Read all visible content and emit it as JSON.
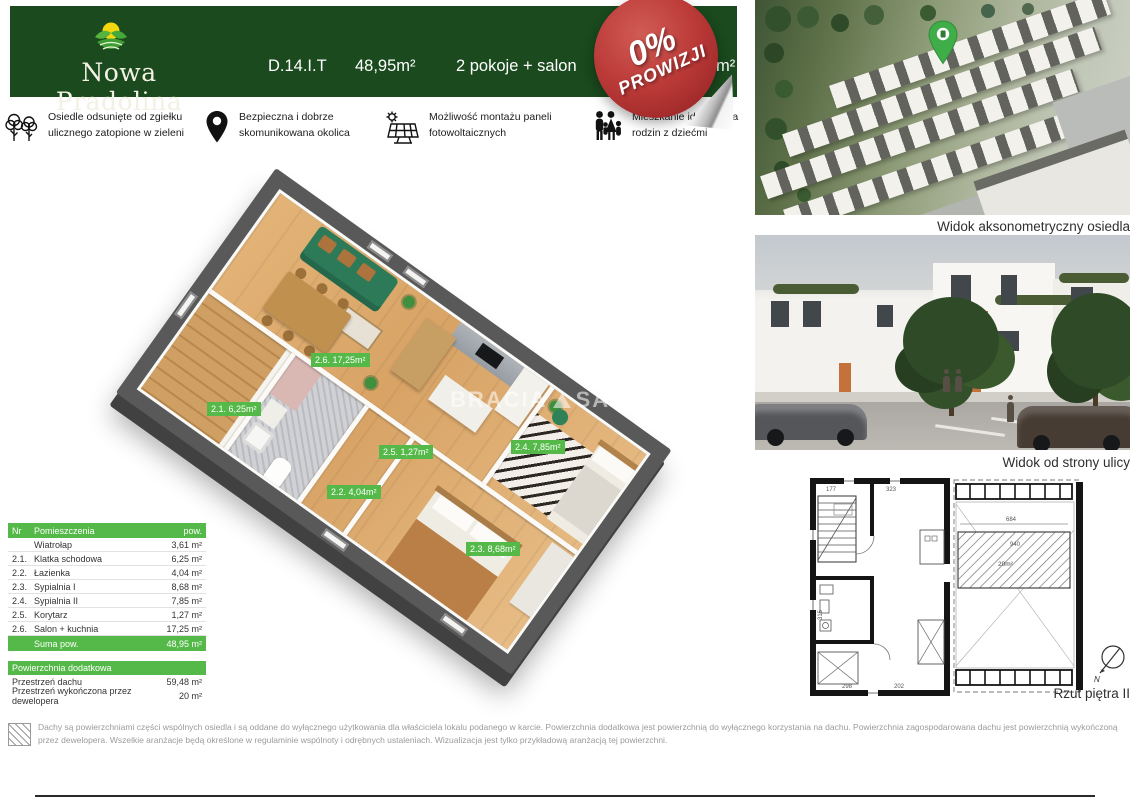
{
  "header": {
    "logo_text": "Nowa Pradolina",
    "unit_id": "D.14.I.T",
    "area": "48,95m²",
    "rooms": "2 pokoje + salon",
    "hidden_left": "P",
    "hidden_right": "m²"
  },
  "stamp": {
    "line1": "0%",
    "line2": "PROWIZJI"
  },
  "features": [
    {
      "icon": "trees-icon",
      "text": "Osiedle odsunięte od zgiełku ulicznego zatopione  w zieleni"
    },
    {
      "icon": "location-pin-icon",
      "text": "Bezpieczna i dobrze skomunikowana okolica"
    },
    {
      "icon": "solar-panel-icon",
      "text": "Możliwość montażu paneli fotowoltaicznych"
    },
    {
      "icon": "family-icon",
      "text": "Mieszkanie idealne dla rodzin z dziećmi"
    }
  ],
  "plan_labels": [
    {
      "room": "2.6",
      "text": "2.6. 17,25m²"
    },
    {
      "room": "2.1",
      "text": "2.1. 6,25m²"
    },
    {
      "room": "2.5",
      "text": "2.5. 1,27m²"
    },
    {
      "room": "2.2",
      "text": "2.2. 4,04m²"
    },
    {
      "room": "2.4",
      "text": "2.4. 7,85m²"
    },
    {
      "room": "2.3",
      "text": "2.3. 8,68m²"
    }
  ],
  "watermark": {
    "part1": "BRACIA",
    "part2": "SADUR"
  },
  "rooms_table": {
    "headers": {
      "nr": "Nr",
      "name": "Pomieszczenia",
      "area": "pow."
    },
    "rows": [
      {
        "nr": "",
        "name": "Wiatrołap",
        "area": "3,61 m²"
      },
      {
        "nr": "2.1.",
        "name": "Klatka schodowa",
        "area": "6,25 m²"
      },
      {
        "nr": "2.2.",
        "name": "Łazienka",
        "area": "4,04 m²"
      },
      {
        "nr": "2.3.",
        "name": "Sypialnia I",
        "area": "8,68 m²"
      },
      {
        "nr": "2.4.",
        "name": "Sypialnia II",
        "area": "7,85 m²"
      },
      {
        "nr": "2.5.",
        "name": "Korytarz",
        "area": "1,27 m²"
      },
      {
        "nr": "2.6.",
        "name": "Salon + kuchnia",
        "area": "17,25 m²"
      }
    ],
    "sum_label": "Suma pow.",
    "sum_value": "48,95 m²"
  },
  "extra_table": {
    "title": "Powierzchnia dodatkowa",
    "rows": [
      {
        "name": "Przestrzeń dachu",
        "area": "59,48 m²"
      },
      {
        "name": "Przestrzeń wykończona przez dewelopera",
        "area": "20 m²"
      }
    ]
  },
  "captions": {
    "aerial": "Widok aksonometryczny osiedla",
    "street": "Widok od strony ulicy",
    "plan": "Rzut piętra II"
  },
  "tech_plan": {
    "dims": {
      "d177": "177",
      "d323": "323",
      "d684": "684",
      "d940": "940",
      "area": "20m²",
      "d315": "315",
      "d298": "298",
      "d202": "202"
    },
    "north": "N"
  },
  "footer": {
    "disclaimer": "Dachy są powierzchniami części wspólnych osiedla i są oddane do wyłącznego użytkowania dla właściciela lokalu podanego w karcie. Powierzchnia dodatkowa jest powierzchnią do wyłącznego korzystania na dachu. Powierzchnia zagospodarowana dachu jest powierzchnią wykończoną przez dewelopera. Wszelkie aranżacje będą określone w regulaminie wspólnoty i odrębnych ustaleniach. Wizualizacja jest tylko przykładową aranżacją tej powierzchni."
  },
  "colors": {
    "accent_green": "#54b948",
    "header_green": "#1a4a1e",
    "stamp_red": "#b03030",
    "logo_yellow": "#f2d60e",
    "logo_green": "#45a838"
  }
}
